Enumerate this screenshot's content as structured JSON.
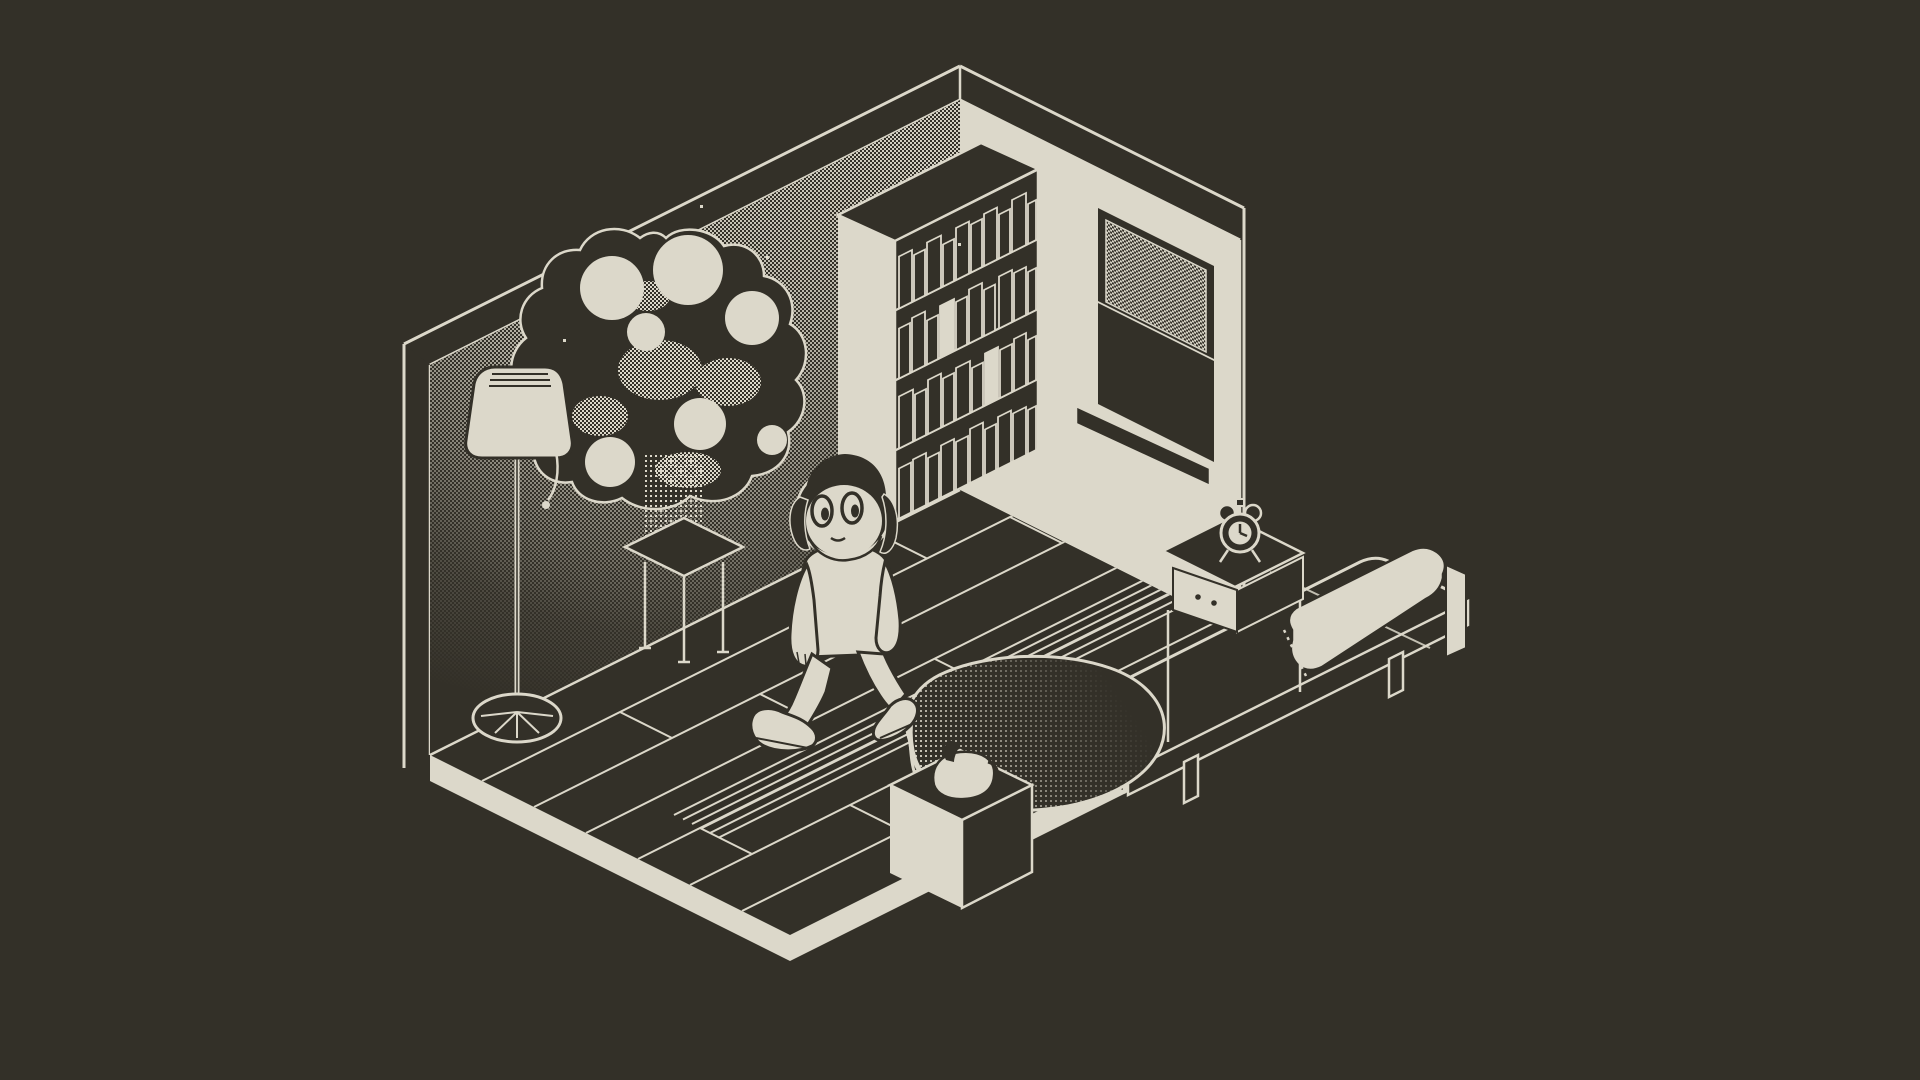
{
  "canvas": {
    "width": 1920,
    "height": 1080
  },
  "palette": {
    "bg": "#333028",
    "ink": "#DCD8CA"
  },
  "scene": {
    "style": "1-bit isometric pixel-art bedroom",
    "objects": [
      {
        "id": "room",
        "label": "isometric room shell"
      },
      {
        "id": "left-wall",
        "label": "left wall with dither shading"
      },
      {
        "id": "right-wall",
        "label": "right wall"
      },
      {
        "id": "window",
        "label": "sash window with dithered glass"
      },
      {
        "id": "bookshelf",
        "label": "bookshelf full of books"
      },
      {
        "id": "plant",
        "label": "potted tree with round foliage"
      },
      {
        "id": "plant-stand",
        "label": "plant stand table"
      },
      {
        "id": "floor-lamp",
        "label": "floor lamp with pull cord"
      },
      {
        "id": "floor",
        "label": "plank floor platform"
      },
      {
        "id": "bed",
        "label": "bed"
      },
      {
        "id": "pillow",
        "label": "pillow with fringe"
      },
      {
        "id": "blanket",
        "label": "bunched blanket"
      },
      {
        "id": "nightstand",
        "label": "nightstand with drawer"
      },
      {
        "id": "alarm-clock",
        "label": "alarm clock"
      },
      {
        "id": "pedestal",
        "label": "pedestal plinth"
      },
      {
        "id": "jug",
        "label": "jug on pedestal"
      },
      {
        "id": "character",
        "label": "walking character"
      }
    ]
  }
}
